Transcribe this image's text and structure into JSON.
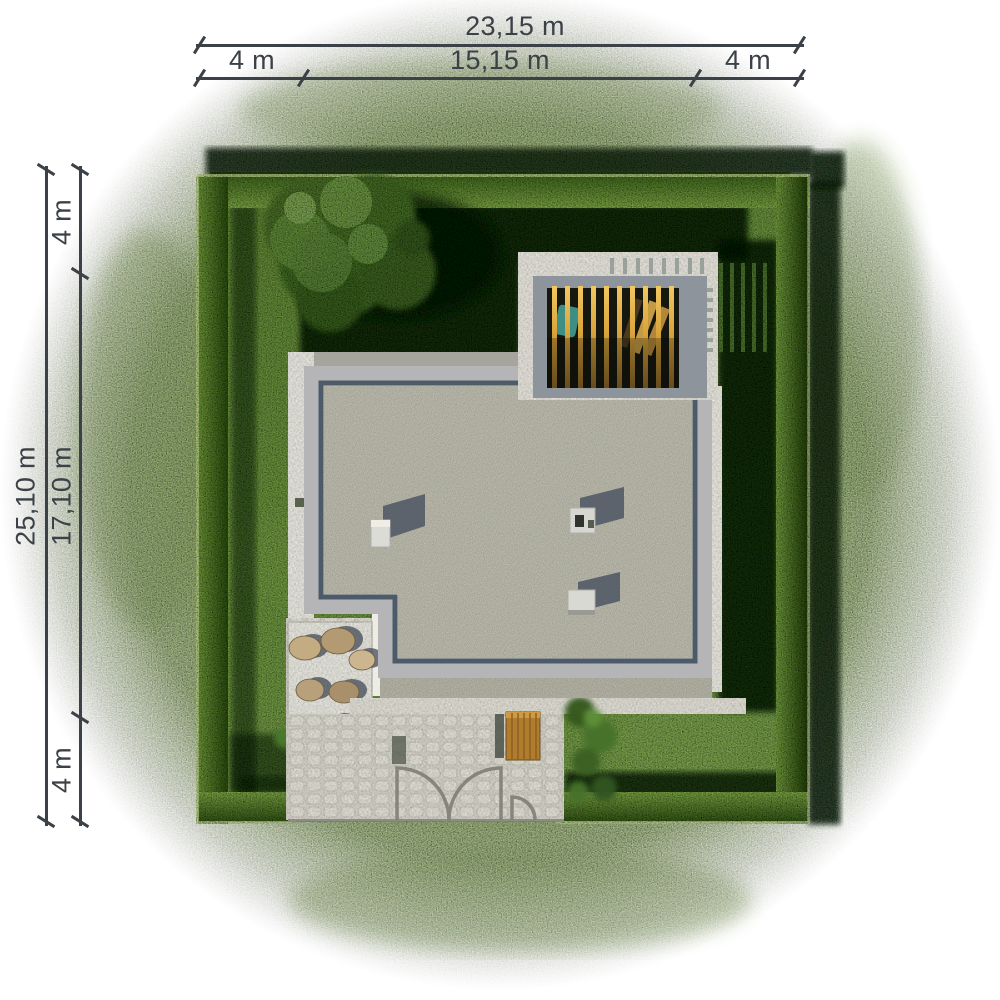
{
  "dimensions": {
    "horizontal": {
      "total": "23,15 m",
      "segments": [
        "4 m",
        "15,15 m",
        "4 m"
      ]
    },
    "vertical": {
      "total": "25,10 m",
      "segments": [
        "4 m",
        "17,10 m",
        "4 m"
      ]
    }
  },
  "colors": {
    "grass_outer": "#a9c77c",
    "grass_plot": "#7cab4b",
    "hedge": "#4a7026",
    "shadow": "#10200a",
    "roof_gravel": "#cbcabb",
    "roof_parapet": "#b5b5b7",
    "roof_edge_line": "#4d5a69",
    "pergola_wood": "#d9a53b",
    "paving": "#e4e2d7",
    "dimension_text": "#3c4147"
  }
}
